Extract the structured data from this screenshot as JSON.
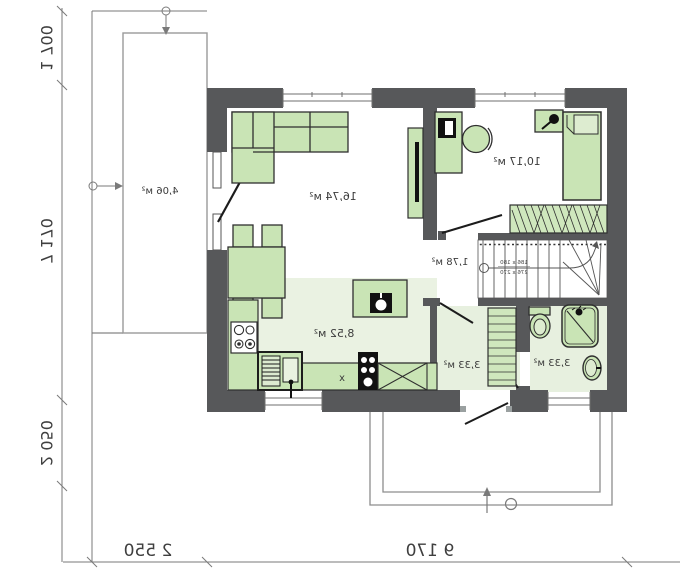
{
  "rooms": {
    "living": {
      "area": "16,74 м²"
    },
    "bedroom": {
      "area": "10,17 м²"
    },
    "kitchen": {
      "area": "8,52 м²"
    },
    "hall": {
      "area": "1,78 м²"
    },
    "entry": {
      "area": "3,33 м²"
    },
    "bath": {
      "area": "3,33 м²"
    },
    "terrace": {
      "area": "4,06 м²"
    }
  },
  "dimensions": {
    "left_top": "1 700",
    "left_mid": "7 170",
    "left_bottom": "2 050",
    "bottom_main": "9 170",
    "bottom_terrace": "2 550"
  },
  "stairs": {
    "note_top": "186 x 180",
    "note_bottom": "276 x 270"
  },
  "kitchen_marks": {
    "cabinet": "x"
  },
  "colors": {
    "wall": "#57585a",
    "furniture": "#c9e4b5",
    "floor": "#eaf2e2"
  }
}
